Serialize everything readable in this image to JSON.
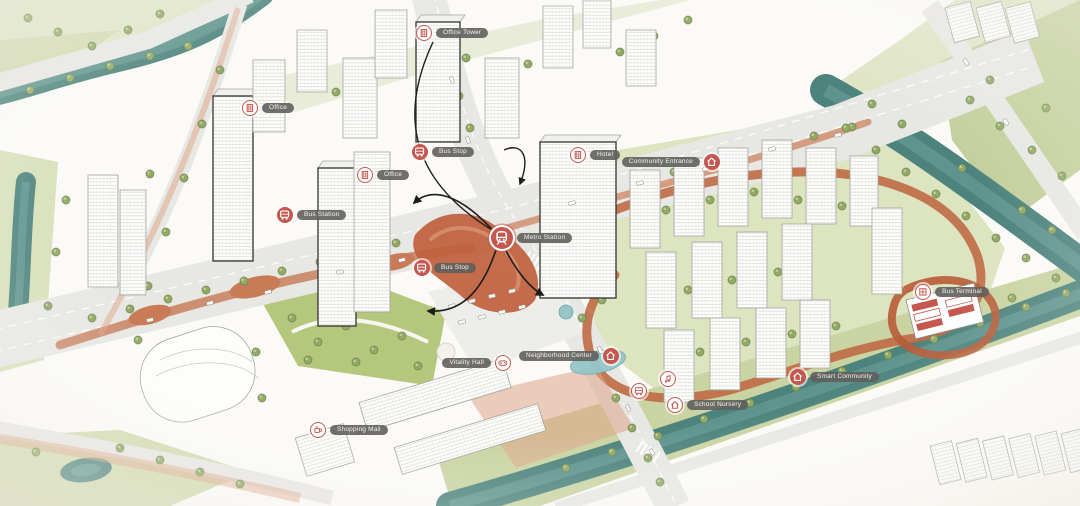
{
  "title": "Mixed-use transit-oriented district masterplan — aerial watercolor illustration",
  "palette": {
    "accent_red": "#c4574e",
    "path_terracotta": "#bf6644",
    "river_teal": "#4c837c",
    "lawn_green": "#b4c77c",
    "pale_green": "#dde4c0",
    "road_gray": "#e7e7e3",
    "building_white": "#ffffff",
    "label_pill_gray": "#615f5c",
    "arrow_black": "#1d1d1b",
    "pool_blue": "#96c6c9"
  },
  "annotations": [
    {
      "icon": "building-icon",
      "style": "outlined",
      "text": "Office Tower"
    },
    {
      "icon": "building-icon",
      "style": "outlined",
      "text": "Office"
    },
    {
      "icon": "building-icon",
      "style": "outlined",
      "text": "Office"
    },
    {
      "icon": "bus-icon",
      "style": "filled",
      "text": "Bus Stop"
    },
    {
      "icon": "bus-icon",
      "style": "filled",
      "text": "Bus Station"
    },
    {
      "icon": "bus-icon",
      "style": "filled",
      "text": "Bus Stop"
    },
    {
      "icon": "metro-icon",
      "style": "filled",
      "text": "Metro Station"
    },
    {
      "icon": "building-icon",
      "style": "outlined",
      "text": "Hotel"
    },
    {
      "icon": "house-icon",
      "style": "filled",
      "text": "Community Entrance"
    },
    {
      "icon": "music-icon",
      "style": "outlined",
      "text": ""
    },
    {
      "icon": "house-icon",
      "style": "outlined",
      "text": "School Nursery"
    },
    {
      "icon": "house-icon",
      "style": "filled",
      "text": "Smart Community"
    },
    {
      "icon": "depot-icon",
      "style": "outlined",
      "text": "Bus Terminal"
    },
    {
      "icon": "controller-icon",
      "style": "outlined",
      "text": "Vitality Hall"
    },
    {
      "icon": "coffee-icon",
      "style": "outlined",
      "text": "Shopping Mall"
    },
    {
      "icon": "house-icon",
      "style": "filled",
      "text": "Neighborhood Center"
    },
    {
      "icon": "bus-icon",
      "style": "outlined",
      "text": ""
    }
  ]
}
